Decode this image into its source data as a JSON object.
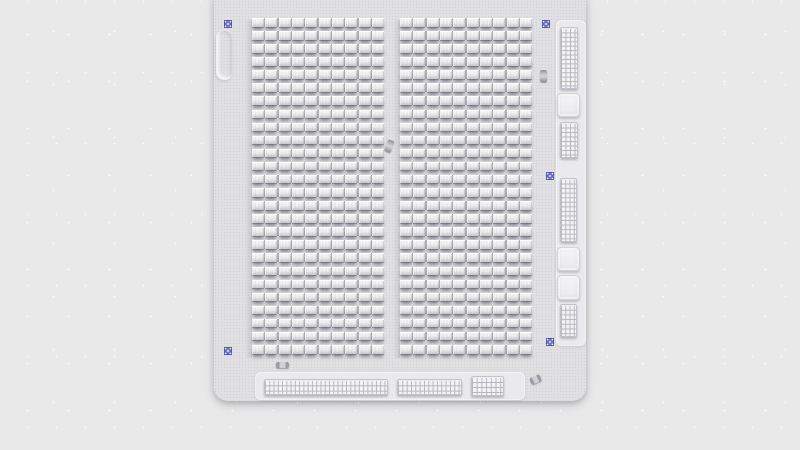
{
  "scene": {
    "description": "Top-down render of a gray circuit board panel with two block arrays, fiducial markers, side pin-grid connectors and bottom pin strips",
    "colors": {
      "background": "#e9e9ea",
      "speckle": "#ffffff",
      "board": "#e0e0e2",
      "board_dot": "#d2d2d6",
      "block_face_top": "#fbfbfc",
      "block_face_bottom": "#e2e2e4",
      "block_shadow": "rgba(58,58,70,0.52)",
      "panel": "#eaeaec",
      "grid_background": "#f3f3f4",
      "grid_line": "#b6b6be",
      "pad": "#f0f0f2",
      "fiducial_purple": "#7171c4",
      "fiducial_dot": "#e9e9ff",
      "component_gray": "#9b9ba1"
    },
    "board": {
      "x": 214,
      "y": -12,
      "w": 372,
      "h": 413,
      "radius": 14
    },
    "block_arrays": [
      {
        "name": "left-block-array",
        "x": 252,
        "y": 18,
        "width": 132,
        "rows": 26,
        "cols": 10,
        "pitch": 13.08,
        "block_h": 8.5
      },
      {
        "name": "right-block-array",
        "x": 400,
        "y": 18,
        "width": 132,
        "rows": 26,
        "cols": 10,
        "pitch": 13.08,
        "block_h": 8.5
      }
    ],
    "fiducials": [
      {
        "name": "fiducial-top-left",
        "x": 224,
        "y": 20,
        "size": 8
      },
      {
        "name": "fiducial-top-right",
        "x": 542,
        "y": 20,
        "size": 8
      },
      {
        "name": "fiducial-mid-right",
        "x": 546,
        "y": 172,
        "size": 8
      },
      {
        "name": "fiducial-bottom-right",
        "x": 546,
        "y": 338,
        "size": 8
      },
      {
        "name": "fiducial-bottom-left",
        "x": 224,
        "y": 347,
        "size": 8
      }
    ],
    "left_slot": {
      "name": "slot-outline-left",
      "x": 216,
      "y": 30,
      "w": 17,
      "h": 50
    },
    "right_panel": {
      "name": "right-connector-panel",
      "x": 556,
      "y": 20,
      "w": 30,
      "h": 326,
      "components": [
        {
          "name": "pin-grid-top",
          "kind": "grid",
          "x": 560,
          "y": 27,
          "w": 18,
          "h": 62,
          "cols": 4,
          "rows": 14
        },
        {
          "name": "pad-square-upper",
          "kind": "square",
          "x": 557,
          "y": 93,
          "w": 23,
          "h": 24
        },
        {
          "name": "pin-grid-upper-mid",
          "kind": "grid",
          "x": 560,
          "y": 122,
          "w": 18,
          "h": 36,
          "cols": 4,
          "rows": 8
        },
        {
          "name": "pin-grid-lower-mid",
          "kind": "grid",
          "x": 560,
          "y": 178,
          "w": 17,
          "h": 64,
          "cols": 4,
          "rows": 14
        },
        {
          "name": "pad-square-mid",
          "kind": "square",
          "x": 557,
          "y": 247,
          "w": 23,
          "h": 24
        },
        {
          "name": "pad-square-lower",
          "kind": "square",
          "x": 557,
          "y": 275,
          "w": 23,
          "h": 25
        },
        {
          "name": "pin-grid-bottom",
          "kind": "grid",
          "x": 560,
          "y": 304,
          "w": 17,
          "h": 33,
          "cols": 4,
          "rows": 7
        }
      ]
    },
    "bottom_panel": {
      "name": "bottom-connector-panel",
      "x": 255,
      "y": 372,
      "w": 270,
      "h": 28,
      "strips": [
        {
          "name": "pin-strip-long",
          "x": 264,
          "y": 379,
          "w": 124,
          "h": 16,
          "cols": 29,
          "rows": 3
        },
        {
          "name": "pin-strip-mid",
          "x": 397,
          "y": 379,
          "w": 65,
          "h": 16,
          "cols": 15,
          "rows": 3
        },
        {
          "name": "pin-strip-small",
          "x": 471,
          "y": 376,
          "w": 33,
          "h": 20,
          "cols": 7,
          "rows": 4
        }
      ]
    },
    "misc_components": [
      {
        "name": "capacitor-right-edge",
        "style": "cap",
        "x": 540,
        "y": 70,
        "w": 7,
        "h": 12,
        "rot": 0
      },
      {
        "name": "chip-center-aisle",
        "style": "cap",
        "x": 386,
        "y": 140,
        "w": 7,
        "h": 12,
        "rot": 20
      },
      {
        "name": "chip-bottom-left",
        "style": "flat",
        "x": 276,
        "y": 362,
        "w": 13,
        "h": 6,
        "rot": 0
      },
      {
        "name": "chip-bottom-right",
        "style": "flat",
        "x": 530,
        "y": 376,
        "w": 11,
        "h": 7,
        "rot": -25
      }
    ]
  }
}
